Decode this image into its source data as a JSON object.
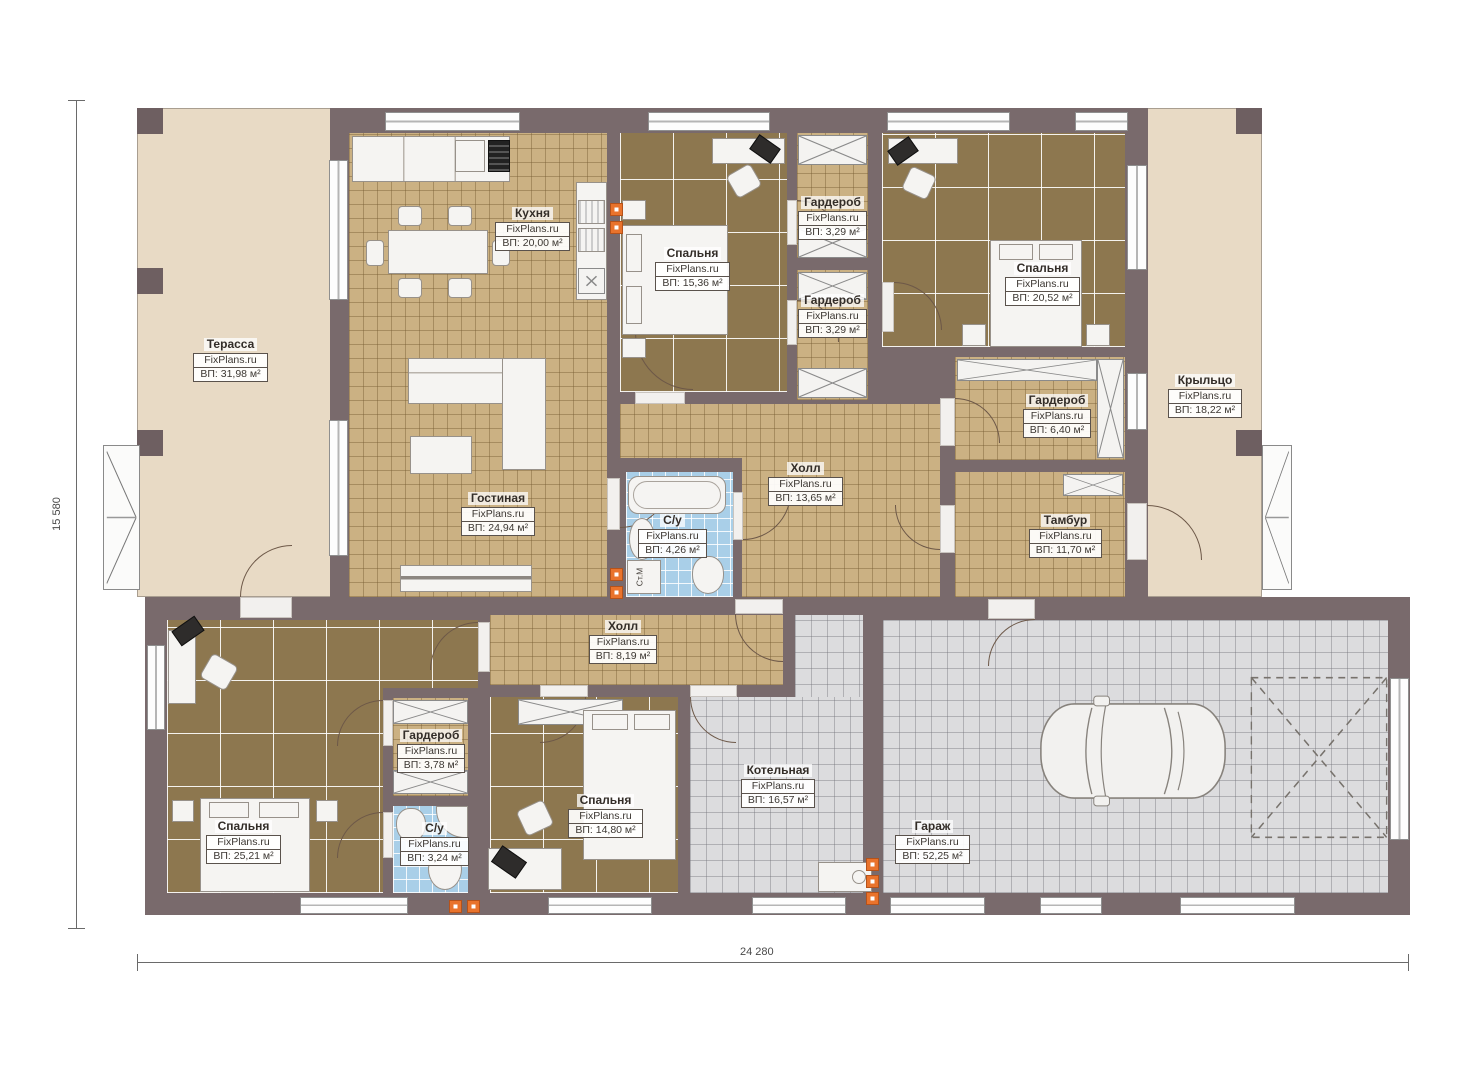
{
  "plan": {
    "title": "Floor plan (single storey house with garage)",
    "brand": "FixPlans.ru",
    "washer_label": "Ст.М",
    "dimensions": {
      "bottom": "24 280",
      "left": "15 580"
    },
    "colors": {
      "wall": "#796a6c",
      "terrace_floor": "#e8dac5",
      "tile_tan": "#cbb183",
      "tile_brown": "#8d774f",
      "tile_blue": "#a9cfe8",
      "tile_gray": "#dcdcde",
      "vent_orange": "#e9732c"
    },
    "rooms": {
      "terrace": {
        "name": "Терасса",
        "area": "ВП: 31,98 м²"
      },
      "kitchen": {
        "name": "Кухня",
        "area": "ВП: 20,00 м²"
      },
      "bedroom1": {
        "name": "Спальня",
        "area": "ВП: 15,36 м²"
      },
      "wardrobe1": {
        "name": "Гардероб",
        "area": "ВП: 3,29 м²"
      },
      "wardrobe2": {
        "name": "Гардероб",
        "area": "ВП: 3,29 м²"
      },
      "bedroom2": {
        "name": "Спальня",
        "area": "ВП: 20,52 м²"
      },
      "wardrobe3": {
        "name": "Гардероб",
        "area": "ВП: 6,40 м²"
      },
      "porch": {
        "name": "Крыльцо",
        "area": "ВП: 18,22 м²"
      },
      "hall1": {
        "name": "Холл",
        "area": "ВП: 13,65 м²"
      },
      "living": {
        "name": "Гостиная",
        "area": "ВП: 24,94 м²"
      },
      "bath1": {
        "name": "С/у",
        "area": "ВП: 4,26 м²"
      },
      "vestibule": {
        "name": "Тамбур",
        "area": "ВП: 11,70 м²"
      },
      "hall2": {
        "name": "Холл",
        "area": "ВП: 8,19 м²"
      },
      "wardrobe4": {
        "name": "Гардероб",
        "area": "ВП: 3,78 м²"
      },
      "bedroom3": {
        "name": "Спальня",
        "area": "ВП: 25,21 м²"
      },
      "bath2": {
        "name": "С/у",
        "area": "ВП: 3,24 м²"
      },
      "bedroom4": {
        "name": "Спальня",
        "area": "ВП: 14,80 м²"
      },
      "boiler": {
        "name": "Котельная",
        "area": "ВП: 16,57 м²"
      },
      "garage": {
        "name": "Гараж",
        "area": "ВП: 52,25 м²"
      }
    }
  }
}
